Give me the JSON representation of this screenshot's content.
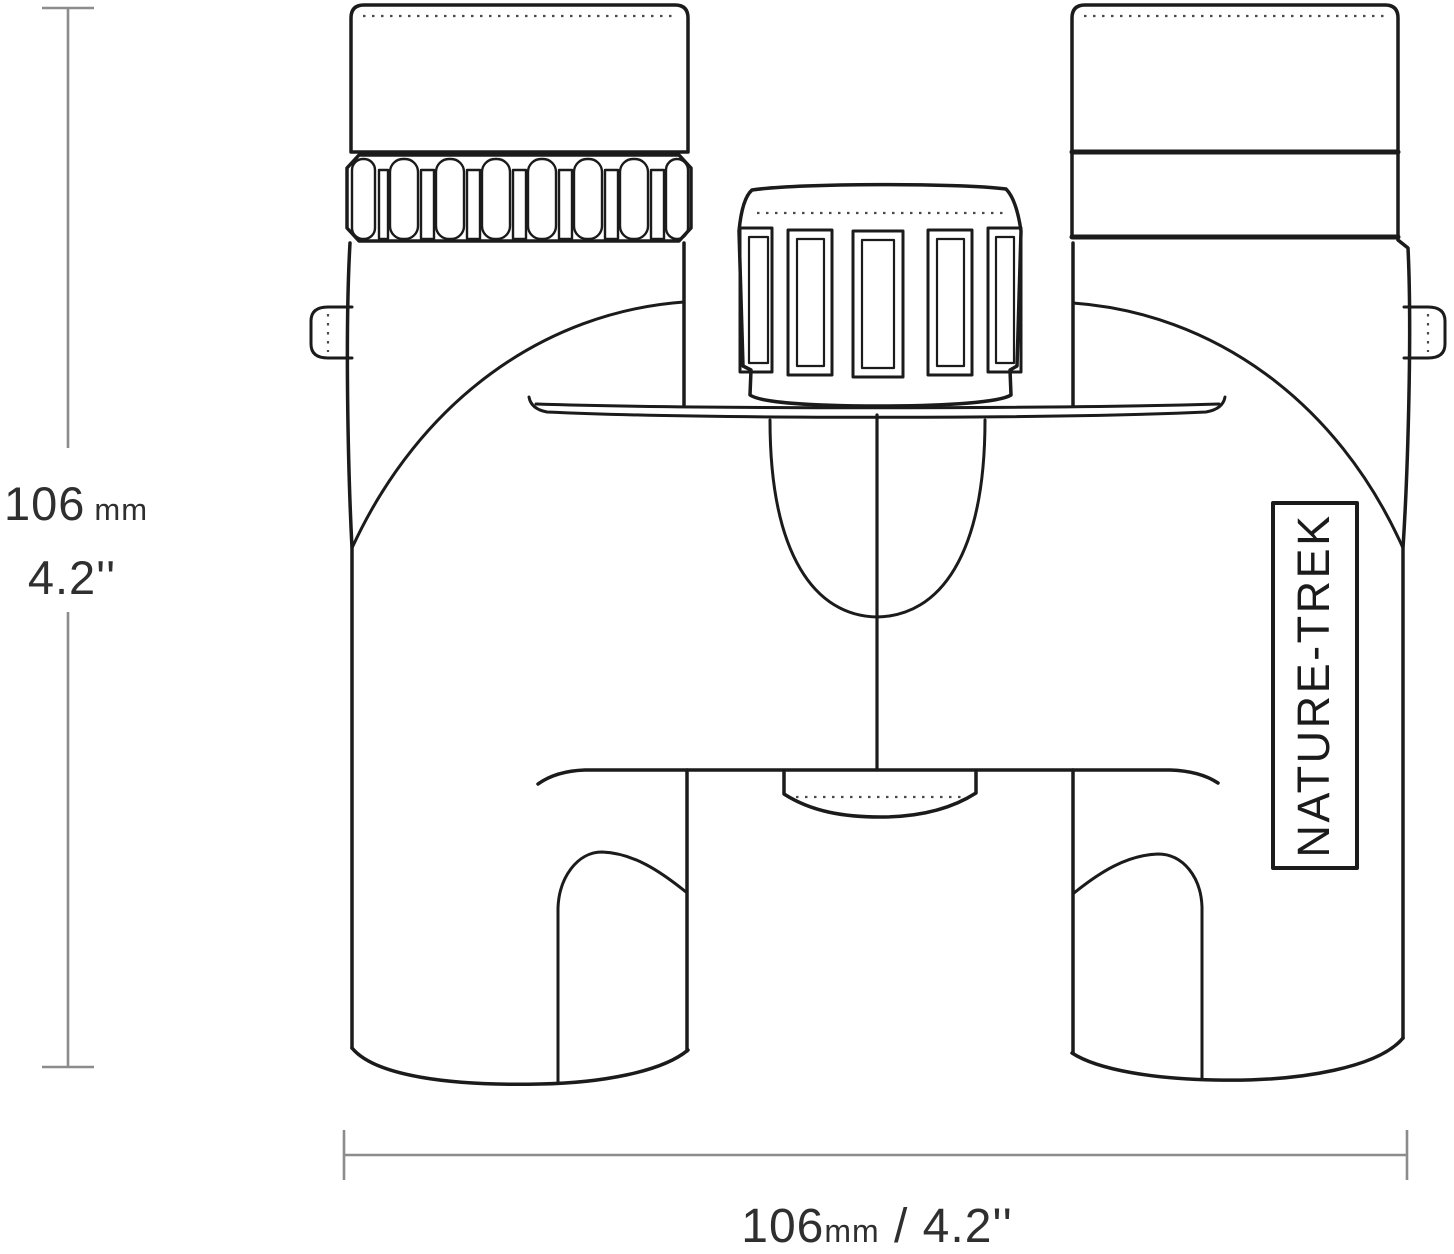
{
  "figure": {
    "type": "product-dimension-diagram",
    "subject": "binoculars-front-view",
    "brand_label": "NATURE-TREK",
    "dim_vertical": {
      "value_mm": "106",
      "unit_mm": "mm",
      "value_inches": "4.2''"
    },
    "dim_horizontal": {
      "value_mm": "106",
      "unit_mm": "mm",
      "rest": " / 4.2''"
    }
  },
  "colors": {
    "line_art": "#1b1b1b",
    "dimension_lines": "#8c8c8c",
    "dimension_text": "#2f2f2f",
    "background": "#ffffff"
  }
}
